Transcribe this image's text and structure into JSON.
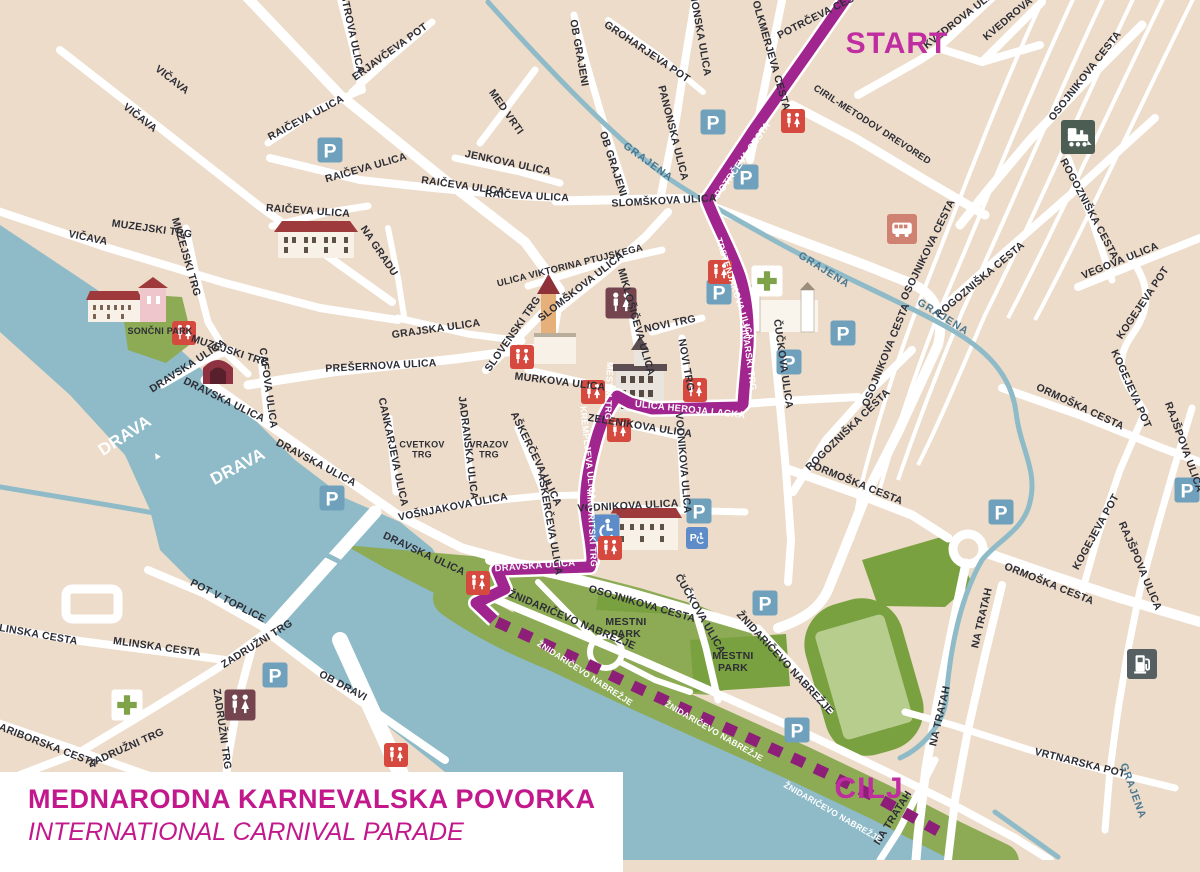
{
  "title_card": {
    "line1": "MEDNARODNA KARNEVALSKA POVORKA",
    "line2": "INTERNATIONAL CARNIVAL PARADE"
  },
  "route": {
    "start_label": "START",
    "finish_label": "CILJ",
    "solid_color": "#a1258e",
    "dashed_color": "#8d1f79",
    "endpoint_color": "#bf2da0"
  },
  "colors": {
    "land": "#ecdcc9",
    "road": "#ffffff",
    "water": "#8fbac8",
    "park": "#8cab54",
    "park_dark": "#7aa13f",
    "stadium_field": "#b7cd8e",
    "label": "#2d2d36",
    "title_text": "#c2188c"
  },
  "map": {
    "icon_types": {
      "parking": {
        "bg": "#6fa0bc",
        "glyph": "P",
        "fg": "#ffffff",
        "size": 25,
        "name": "parking-icon"
      },
      "parking_disabled": {
        "bg": "#5d8cc9",
        "sym": "pwheel",
        "fg": "#ffffff",
        "size": 22,
        "name": "disabled-parking-icon"
      },
      "wheelchair": {
        "bg": "#5d8cc9",
        "sym": "wheel",
        "fg": "#ffffff",
        "size": 27,
        "name": "wheelchair-access-icon"
      },
      "wc": {
        "bg": "#d6493f",
        "sym": "wc",
        "fg": "#ffffff",
        "size": 24,
        "name": "toilets-icon"
      },
      "wc_dark": {
        "bg": "#74454e",
        "sym": "wc",
        "fg": "#ffffff",
        "size": 31,
        "name": "toilets-icon"
      },
      "pharmacy": {
        "bg": "#ffffff",
        "sym": "cross",
        "fg": "#7fa348",
        "size": 31,
        "name": "pharmacy-icon"
      },
      "bus": {
        "bg": "#cf8272",
        "sym": "bus",
        "fg": "#ffffff",
        "size": 30,
        "name": "bus-station-icon"
      },
      "train": {
        "bg": "#4c5e54",
        "sym": "train",
        "fg": "#ffffff",
        "size": 34,
        "name": "train-station-icon"
      },
      "fuel": {
        "bg": "#565f62",
        "sym": "fuel",
        "fg": "#ffffff",
        "size": 30,
        "name": "fuel-station-icon"
      }
    },
    "icons": [
      {
        "type": "parking",
        "x": 330,
        "y": 150
      },
      {
        "type": "parking",
        "x": 713,
        "y": 122
      },
      {
        "type": "parking",
        "x": 746,
        "y": 177
      },
      {
        "type": "parking",
        "x": 719,
        "y": 292
      },
      {
        "type": "parking",
        "x": 843,
        "y": 333
      },
      {
        "type": "parking",
        "x": 789,
        "y": 362
      },
      {
        "type": "parking",
        "x": 332,
        "y": 498
      },
      {
        "type": "parking",
        "x": 699,
        "y": 511
      },
      {
        "type": "parking",
        "x": 765,
        "y": 603
      },
      {
        "type": "parking",
        "x": 797,
        "y": 730
      },
      {
        "type": "parking",
        "x": 275,
        "y": 675
      },
      {
        "type": "parking",
        "x": 1001,
        "y": 512
      },
      {
        "type": "parking",
        "x": 1187,
        "y": 490
      },
      {
        "type": "parking_disabled",
        "x": 697,
        "y": 538
      },
      {
        "type": "wheelchair",
        "x": 606,
        "y": 528
      },
      {
        "type": "wc",
        "x": 184,
        "y": 333
      },
      {
        "type": "wc",
        "x": 793,
        "y": 121
      },
      {
        "type": "wc",
        "x": 720,
        "y": 272
      },
      {
        "type": "wc",
        "x": 522,
        "y": 357
      },
      {
        "type": "wc",
        "x": 695,
        "y": 390
      },
      {
        "type": "wc",
        "x": 593,
        "y": 392
      },
      {
        "type": "wc",
        "x": 619,
        "y": 430
      },
      {
        "type": "wc",
        "x": 610,
        "y": 548
      },
      {
        "type": "wc",
        "x": 478,
        "y": 583
      },
      {
        "type": "wc",
        "x": 396,
        "y": 755
      },
      {
        "type": "wc_dark",
        "x": 621,
        "y": 303
      },
      {
        "type": "wc_dark",
        "x": 240,
        "y": 705
      },
      {
        "type": "pharmacy",
        "x": 767,
        "y": 281
      },
      {
        "type": "pharmacy",
        "x": 127,
        "y": 705
      },
      {
        "type": "bus",
        "x": 902,
        "y": 229
      },
      {
        "type": "train",
        "x": 1078,
        "y": 137
      },
      {
        "type": "fuel",
        "x": 1142,
        "y": 664
      }
    ],
    "street_labels": [
      {
        "t": "VIČAVA",
        "x": 172,
        "y": 80,
        "r": 38
      },
      {
        "t": "VIČAVA",
        "x": 140,
        "y": 118,
        "r": 38
      },
      {
        "t": "VIČAVA",
        "x": 88,
        "y": 238,
        "r": 12
      },
      {
        "t": "MUZEJSKI TRG",
        "x": 152,
        "y": 229,
        "r": 8
      },
      {
        "t": "MUZEJSKI TRG",
        "x": 186,
        "y": 257,
        "r": 74
      },
      {
        "t": "MUZEJSKI TRG",
        "x": 230,
        "y": 351,
        "r": 18
      },
      {
        "t": "MAISTROVA ULICA",
        "x": 350,
        "y": 24,
        "r": 78
      },
      {
        "t": "ERJAVČEVA POT",
        "x": 390,
        "y": 52,
        "r": -36
      },
      {
        "t": "RAIČEVA ULICA",
        "x": 306,
        "y": 118,
        "r": -28
      },
      {
        "t": "RAIČEVA ULICA",
        "x": 366,
        "y": 168,
        "r": -16
      },
      {
        "t": "RAIČEVA ULICA",
        "x": 308,
        "y": 211,
        "r": 4
      },
      {
        "t": "RAIČEVA ULICA",
        "x": 463,
        "y": 186,
        "r": 8
      },
      {
        "t": "RAIČEVA ULICA",
        "x": 527,
        "y": 196,
        "r": 3
      },
      {
        "t": "SLOMŠKOVA ULICA",
        "x": 664,
        "y": 201,
        "r": -3
      },
      {
        "t": "SLOMŠKOVA ULICA",
        "x": 581,
        "y": 287,
        "r": -38
      },
      {
        "t": "NA GRADU",
        "x": 379,
        "y": 251,
        "r": 56
      },
      {
        "t": "GRAJSKA ULICA",
        "x": 436,
        "y": 329,
        "r": -8
      },
      {
        "t": "PREŠERNOVA ULICA",
        "x": 381,
        "y": 366,
        "r": -3
      },
      {
        "t": "SLOVENSKI TRG",
        "x": 513,
        "y": 334,
        "r": -55
      },
      {
        "t": "ULICA VIKTORINA PTUJSKEGA",
        "x": 570,
        "y": 266,
        "r": -14,
        "s": 9.5
      },
      {
        "t": "MIKLOŠIČEVA ULICA",
        "x": 636,
        "y": 322,
        "r": 74
      },
      {
        "t": "NOVI TRG",
        "x": 670,
        "y": 324,
        "r": -12
      },
      {
        "t": "NOVI TRG",
        "x": 686,
        "y": 365,
        "r": 80
      },
      {
        "t": "MURKOVA ULICA",
        "x": 560,
        "y": 382,
        "r": 7
      },
      {
        "t": "ZELENIKOVA ULICA",
        "x": 640,
        "y": 426,
        "r": 9
      },
      {
        "t": "VODNIKOVA ULICA",
        "x": 683,
        "y": 463,
        "r": 85
      },
      {
        "t": "VODNIKOVA ULICA",
        "x": 628,
        "y": 506,
        "r": -3
      },
      {
        "t": "AŠKERČEVA ULICA",
        "x": 536,
        "y": 459,
        "r": 64
      },
      {
        "t": "AŠKERČEVA ULICA",
        "x": 550,
        "y": 524,
        "r": 80
      },
      {
        "t": "JADRANSKA ULICA",
        "x": 468,
        "y": 448,
        "r": 83
      },
      {
        "t": "VRAZOV TRG",
        "x": 489,
        "y": 450,
        "r": 0,
        "s": 9,
        "st": 1
      },
      {
        "t": "CANKARJEVA ULICA",
        "x": 393,
        "y": 452,
        "r": 78
      },
      {
        "t": "CVETKOV TRG",
        "x": 422,
        "y": 450,
        "r": 0,
        "s": 9,
        "st": 1
      },
      {
        "t": "VOŠNJAKOVA ULICA",
        "x": 453,
        "y": 507,
        "r": -11
      },
      {
        "t": "CAFOVA ULICA",
        "x": 268,
        "y": 388,
        "r": 82
      },
      {
        "t": "DRAVSKA ULICA",
        "x": 188,
        "y": 366,
        "r": -33
      },
      {
        "t": "DRAVSKA ULICA",
        "x": 224,
        "y": 400,
        "r": 26
      },
      {
        "t": "DRAVSKA ULICA",
        "x": 316,
        "y": 463,
        "r": 28
      },
      {
        "t": "DRAVSKA ULICA",
        "x": 424,
        "y": 554,
        "r": 25
      },
      {
        "t": "DRAVSKA ULICA",
        "x": 535,
        "y": 566,
        "r": -4,
        "c": "w",
        "s": 9.5
      },
      {
        "t": "SONČNI PARK",
        "x": 160,
        "y": 331,
        "r": 0,
        "s": 9
      },
      {
        "t": "MLINSKA CESTA",
        "x": 34,
        "y": 634,
        "r": 10
      },
      {
        "t": "MLINSKA CESTA",
        "x": 157,
        "y": 647,
        "r": 8
      },
      {
        "t": "ZADRUŽNI TRG",
        "x": 257,
        "y": 644,
        "r": -32
      },
      {
        "t": "ZADRUŽNI TRG",
        "x": 222,
        "y": 729,
        "r": 82
      },
      {
        "t": "ZADRUŽNI TRG",
        "x": 126,
        "y": 748,
        "r": -24
      },
      {
        "t": "MARIBORSKA CESTA",
        "x": 44,
        "y": 744,
        "r": 21
      },
      {
        "t": "POT V TOPLICE",
        "x": 228,
        "y": 601,
        "r": 27
      },
      {
        "t": "OB DRAVI",
        "x": 343,
        "y": 686,
        "r": 28
      },
      {
        "t": "OB GRAJENI",
        "x": 579,
        "y": 53,
        "r": 80
      },
      {
        "t": "OB GRAJENI",
        "x": 613,
        "y": 164,
        "r": 72
      },
      {
        "t": "GROHARJEVA POT",
        "x": 647,
        "y": 52,
        "r": 34
      },
      {
        "t": "MED VRTI",
        "x": 506,
        "y": 112,
        "r": 55
      },
      {
        "t": "JENKOVA ULICA",
        "x": 508,
        "y": 163,
        "r": 12
      },
      {
        "t": "PANONSKA ULICA",
        "x": 699,
        "y": 28,
        "r": 80
      },
      {
        "t": "PANONSKA ULICA",
        "x": 673,
        "y": 133,
        "r": 76
      },
      {
        "t": "VOLKMERJEVA CESTA",
        "x": 770,
        "y": 52,
        "r": 74
      },
      {
        "t": "POTRČEVA CESTA",
        "x": 822,
        "y": 14,
        "r": -27
      },
      {
        "t": "CIRIL-METODOV DREVORED",
        "x": 872,
        "y": 125,
        "r": 33,
        "s": 9.5
      },
      {
        "t": "KVEDROVA ULICA",
        "x": 963,
        "y": 17,
        "r": -38
      },
      {
        "t": "KVEDROVA",
        "x": 1008,
        "y": 19,
        "r": -40
      },
      {
        "t": "OSOJNIKOVA CESTA",
        "x": 1085,
        "y": 76,
        "r": -52
      },
      {
        "t": "OSOJNIKOVA CESTA",
        "x": 928,
        "y": 250,
        "r": -64
      },
      {
        "t": "OSOJNIKOVA CESTA",
        "x": 886,
        "y": 355,
        "r": -68
      },
      {
        "t": "OSOJNIKOVA CESTA",
        "x": 642,
        "y": 604,
        "r": 16
      },
      {
        "t": "ROGOZNIŠKA CESTA",
        "x": 1089,
        "y": 209,
        "r": 62
      },
      {
        "t": "ROGOZNIŠKA CESTA",
        "x": 980,
        "y": 280,
        "r": -40
      },
      {
        "t": "ROGOZNIŠKA CESTA",
        "x": 848,
        "y": 430,
        "r": -44
      },
      {
        "t": "VEGOVA ULICA",
        "x": 1120,
        "y": 261,
        "r": -22
      },
      {
        "t": "ORMOŠKA CESTA",
        "x": 1080,
        "y": 407,
        "r": 25
      },
      {
        "t": "ORMOŠKA CESTA",
        "x": 858,
        "y": 484,
        "r": 22
      },
      {
        "t": "ORMOŠKA CESTA",
        "x": 1049,
        "y": 584,
        "r": 22
      },
      {
        "t": "KOGEJEVA POT",
        "x": 1143,
        "y": 303,
        "r": -56
      },
      {
        "t": "KOGEJEVA POT",
        "x": 1131,
        "y": 389,
        "r": 66
      },
      {
        "t": "KOGEJEVA POT",
        "x": 1096,
        "y": 532,
        "r": -61
      },
      {
        "t": "RAJŠPOVA ULICA",
        "x": 1184,
        "y": 447,
        "r": 70
      },
      {
        "t": "RAJŠPOVA ULICA",
        "x": 1140,
        "y": 566,
        "r": 67
      },
      {
        "t": "NA TRATAH",
        "x": 982,
        "y": 618,
        "r": -77
      },
      {
        "t": "NA TRATAH",
        "x": 940,
        "y": 716,
        "r": -77
      },
      {
        "t": "NA TRATAH",
        "x": 893,
        "y": 818,
        "r": -58
      },
      {
        "t": "VRTNARSKA POT",
        "x": 1080,
        "y": 763,
        "r": 14
      },
      {
        "t": "ČUČKOVA ULICA",
        "x": 783,
        "y": 364,
        "r": 82
      },
      {
        "t": "ČUČKOVA ULICA",
        "x": 700,
        "y": 614,
        "r": 60
      },
      {
        "t": "ŽNIDARIČEVO NABREŽJE",
        "x": 572,
        "y": 620,
        "r": 23
      },
      {
        "t": "ŽNIDARIČEVO NABREŽJE",
        "x": 785,
        "y": 663,
        "r": 47
      },
      {
        "t": "ŽNIDARIČEVO NABREŽJE",
        "x": 585,
        "y": 673,
        "r": 33,
        "c": "w",
        "s": 8.5
      },
      {
        "t": "ŽNIDARIČEVO NABREŽJE",
        "x": 714,
        "y": 731,
        "r": 30,
        "c": "w",
        "s": 8.5
      },
      {
        "t": "ŽNIDARIČEVO NABREŽJE",
        "x": 833,
        "y": 812,
        "r": 30,
        "c": "w",
        "s": 8.5
      },
      {
        "t": "GRAJENA",
        "x": 648,
        "y": 162,
        "r": 36,
        "c": "b"
      },
      {
        "t": "GRAJENA",
        "x": 824,
        "y": 270,
        "r": 32,
        "c": "b"
      },
      {
        "t": "GRAJENA",
        "x": 943,
        "y": 317,
        "r": 32,
        "c": "b"
      },
      {
        "t": "GRAJENA",
        "x": 1133,
        "y": 791,
        "r": 70,
        "c": "b"
      },
      {
        "t": "MESTNI PARK",
        "x": 626,
        "y": 628,
        "r": 0,
        "st": 1
      },
      {
        "t": "MESTNI PARK",
        "x": 733,
        "y": 662,
        "r": 0,
        "st": 1
      },
      {
        "t": "DRAVA",
        "x": 125,
        "y": 436,
        "r": -33,
        "c": "w",
        "s": 17
      },
      {
        "t": "▲",
        "x": 157,
        "y": 456,
        "r": -33,
        "c": "w",
        "s": 10
      },
      {
        "t": "DRAVA",
        "x": 238,
        "y": 467,
        "r": -28,
        "c": "w",
        "s": 17
      },
      {
        "t": "MESTNI TRG",
        "x": 609,
        "y": 391,
        "r": 92,
        "c": "w",
        "s": 9
      },
      {
        "t": "KREMPLJEVA ULICA",
        "x": 588,
        "y": 453,
        "r": 84,
        "c": "w",
        "s": 9
      },
      {
        "t": "MINORITSKI TRG",
        "x": 592,
        "y": 528,
        "r": 87,
        "c": "w",
        "s": 9
      },
      {
        "t": "TRSTENJAKOVA ULICA",
        "x": 735,
        "y": 289,
        "r": 72,
        "c": "w",
        "s": 9
      },
      {
        "t": "VINARSKI TRG",
        "x": 749,
        "y": 357,
        "r": 82,
        "c": "w",
        "s": 9
      },
      {
        "t": "ULICA HEROJA LACKA",
        "x": 690,
        "y": 410,
        "r": 6,
        "c": "w",
        "s": 9.5
      },
      {
        "t": "POTRČEVA CESTA",
        "x": 743,
        "y": 160,
        "r": -55,
        "c": "w",
        "s": 9.5
      }
    ]
  }
}
